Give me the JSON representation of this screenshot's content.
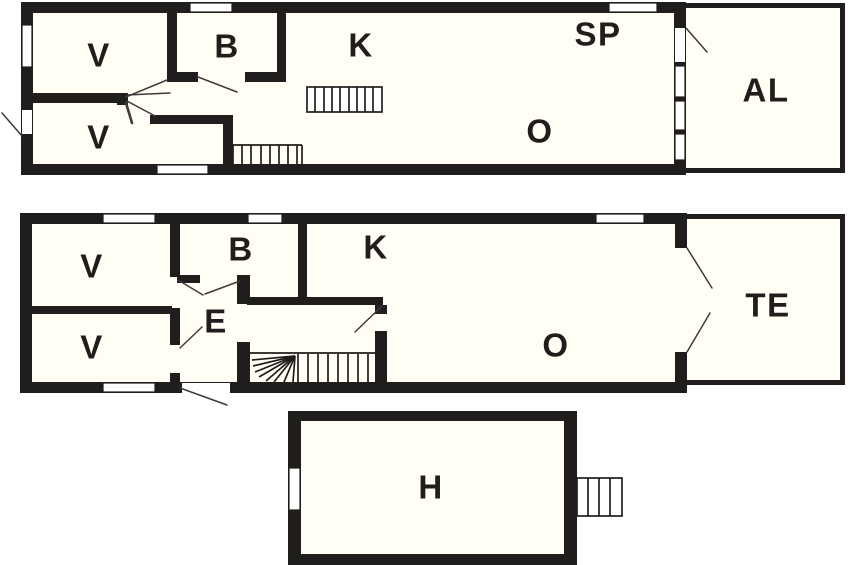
{
  "floorplan": {
    "colors": {
      "wall": "#201e1c",
      "floor": "#fffdf4",
      "background": "#ffffff",
      "door_line": "#3c3c3c"
    },
    "floors": [
      {
        "rooms": [
          {
            "label": "V"
          },
          {
            "label": "B"
          },
          {
            "label": "K"
          },
          {
            "label": "SP"
          },
          {
            "label": "O"
          },
          {
            "label": "V"
          },
          {
            "label": "AL"
          }
        ]
      },
      {
        "rooms": [
          {
            "label": "V"
          },
          {
            "label": "B"
          },
          {
            "label": "K"
          },
          {
            "label": "E"
          },
          {
            "label": "V"
          },
          {
            "label": "O"
          },
          {
            "label": "TE"
          }
        ]
      },
      {
        "rooms": [
          {
            "label": "H"
          }
        ]
      }
    ]
  }
}
